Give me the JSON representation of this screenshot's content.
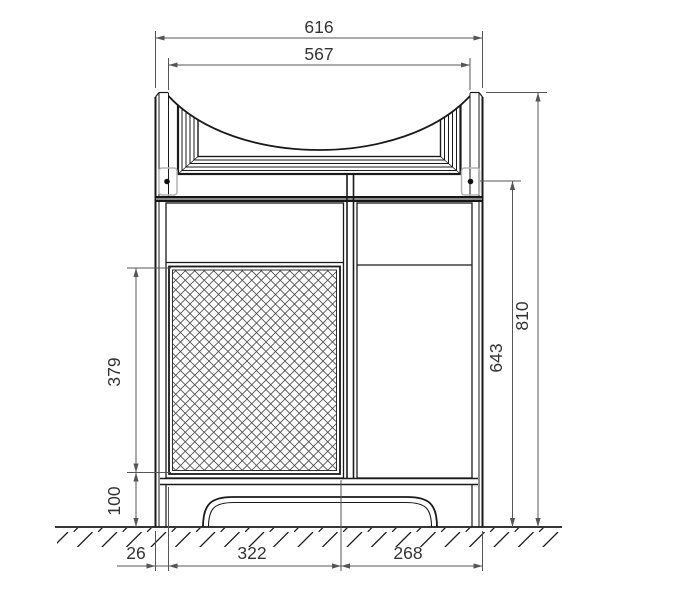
{
  "drawing": {
    "type": "technical-dimension-drawing",
    "subject": "bathroom-vanity-washbasin-cabinet-front-elevation",
    "colors": {
      "object_line": "#1a1a1a",
      "dimension_line": "#555555",
      "hatch_line": "#4a4a4a",
      "hinge_plate": "#b3b3b3",
      "background": "#ffffff"
    },
    "dims": {
      "overall_width": "616",
      "basin_inner_width": "567",
      "overall_height": "810",
      "height_below_basin": "643",
      "basket_panel_height": "379",
      "plinth_height": "100",
      "side_panel_thickness": "26",
      "left_compartment_width": "322",
      "right_compartment_width": "268"
    }
  }
}
